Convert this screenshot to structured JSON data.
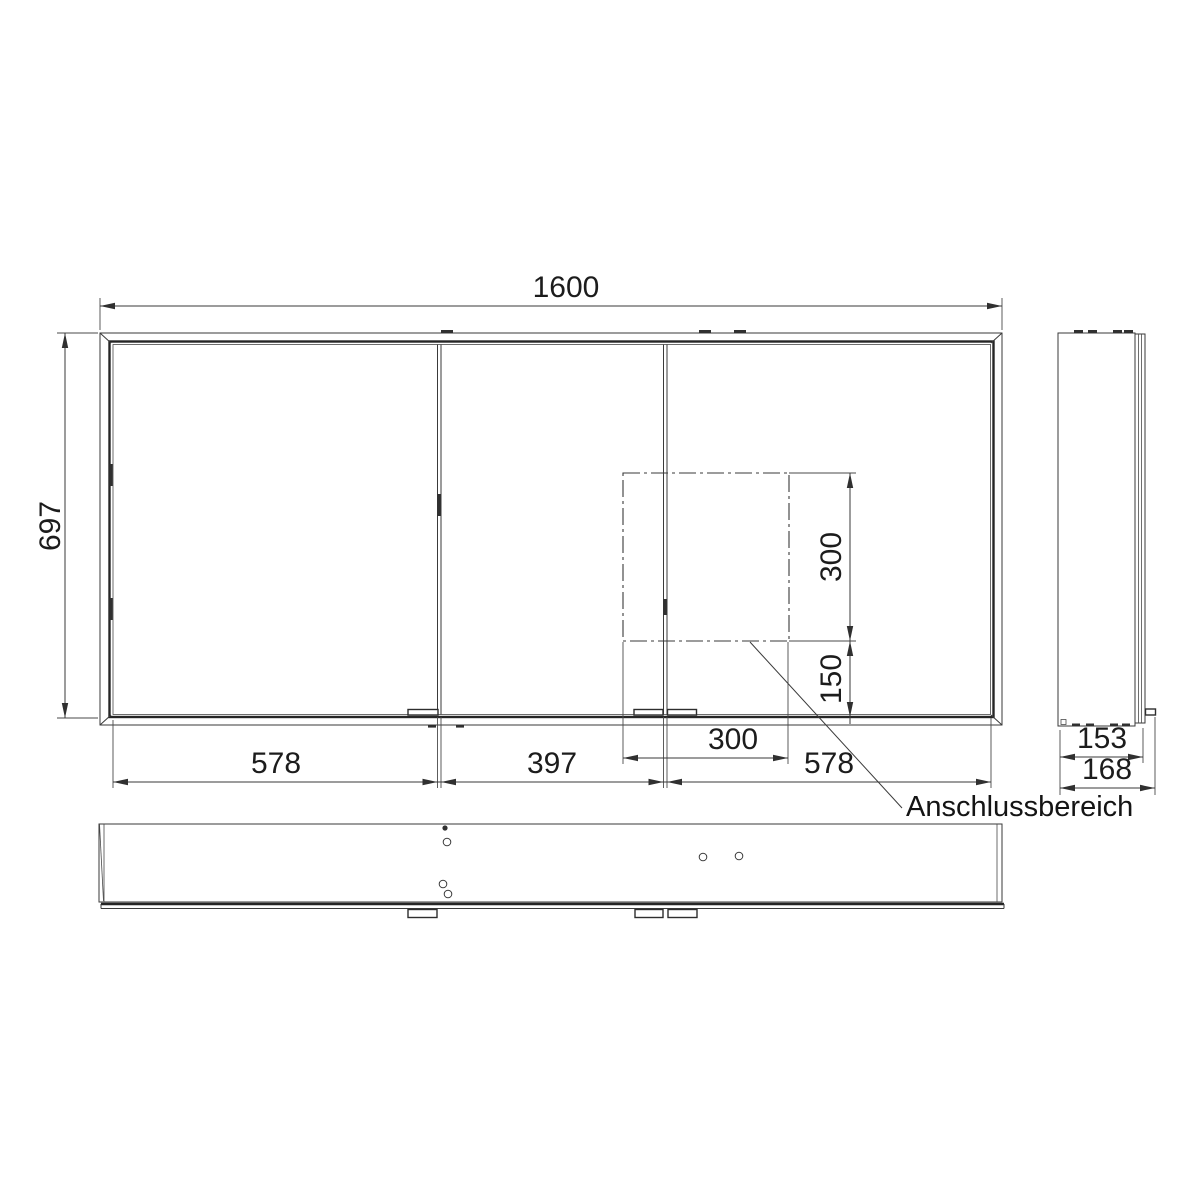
{
  "drawing": {
    "front_view": {
      "width_label": "1600",
      "height_label": "697",
      "door_widths": {
        "left": "578",
        "middle": "397",
        "right": "578"
      },
      "connection_area": {
        "width_label": "300",
        "height_label": "300",
        "offset_label": "150",
        "leader_label": "Anschlussbereich"
      }
    },
    "side_view": {
      "depth_inner_label": "153",
      "depth_total_label": "168"
    },
    "colors": {
      "line": "#3a3a3a",
      "background": "#ffffff"
    }
  }
}
